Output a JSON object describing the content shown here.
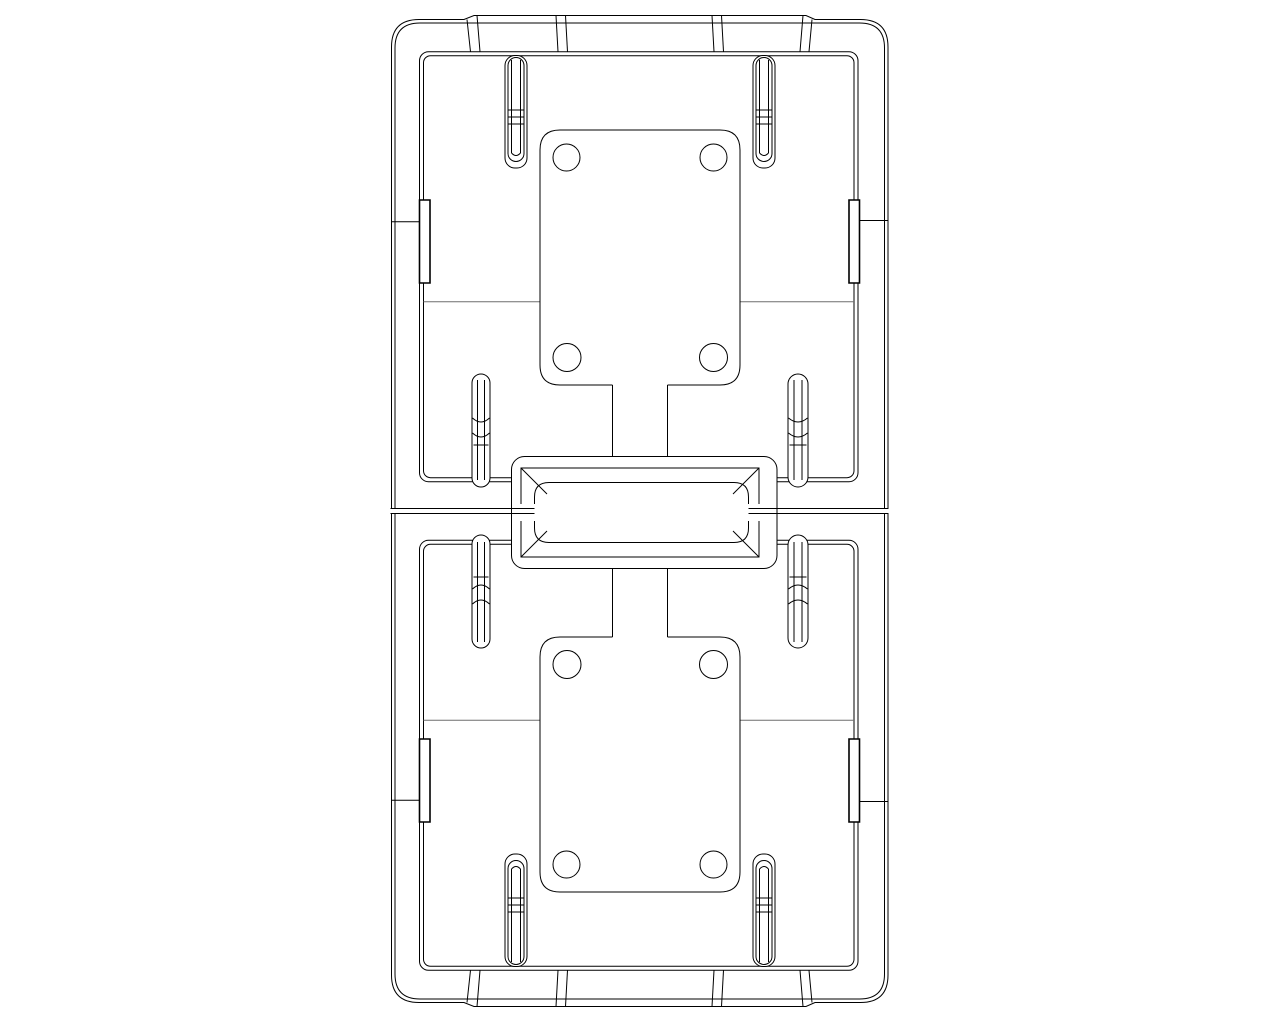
{
  "meta": {
    "description": "Monochrome CAD wireframe drawing: two mirrored rectangular enclosure halves stacked vertically, joined by a central latch connector; each half contains a rounded mounting plate with four screw holes, corner pin slots, mid slots, side notch tabs and a gray datum centerline.",
    "canvas": {
      "width": 1280,
      "height": 1024
    }
  },
  "colors": {
    "background": "#ffffff",
    "line": "#000000",
    "fill": "#ffffff",
    "centerline": "#6e6e6e"
  },
  "drawing": {
    "type": "technical-line-drawing",
    "parts": [
      {
        "name": "upper-enclosure-half",
        "bounds": [
          391,
          16,
          888,
          509
        ]
      },
      {
        "name": "lower-enclosure-half",
        "bounds": [
          391,
          513,
          888,
          1006
        ]
      },
      {
        "name": "latch-connector",
        "bounds": [
          512,
          457,
          777,
          568
        ]
      },
      {
        "name": "mounting-plate-upper",
        "bounds": [
          540,
          130,
          740,
          385
        ],
        "screw_holes": 4
      },
      {
        "name": "mounting-plate-lower",
        "bounds": [
          540,
          637,
          740,
          892
        ],
        "screw_holes": 4
      },
      {
        "name": "corner-pin-slots",
        "count": 4
      },
      {
        "name": "mid-slots",
        "count": 4
      },
      {
        "name": "side-notch-tabs",
        "count": 4
      },
      {
        "name": "parting-lines",
        "y": [
          508.5,
          513.5
        ]
      },
      {
        "name": "datum-centerlines",
        "y": [
          301.7,
          720.3
        ]
      }
    ]
  }
}
